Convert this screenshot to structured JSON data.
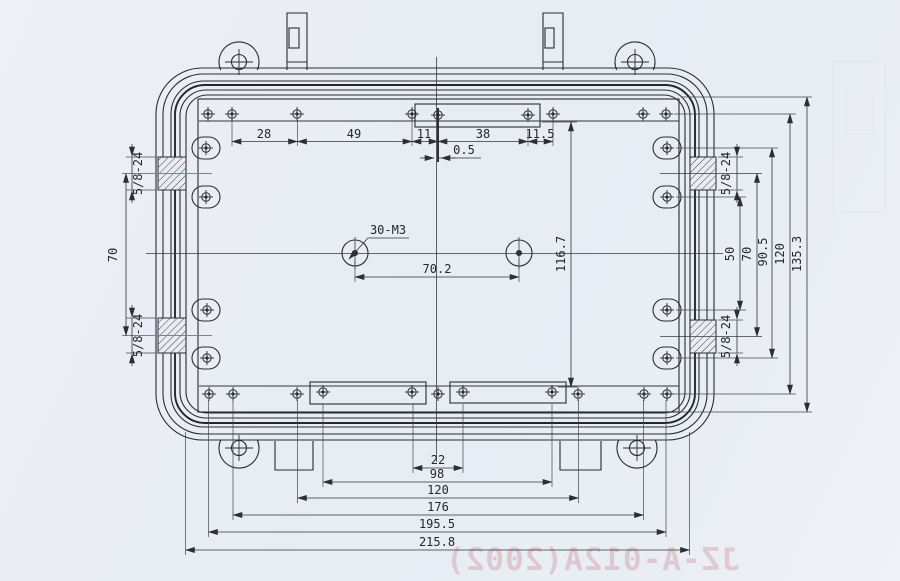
{
  "drawing": {
    "callout_holes": "30-M3",
    "thread_spec": "5/8-24",
    "dim_top": [
      "28",
      "49",
      "11",
      "38",
      "11.5"
    ],
    "dim_offset": "0.5",
    "dim_hole_spacing": "70.2",
    "dim_inner_height": "116.7",
    "dim_left_span": "70",
    "dim_right": [
      "50",
      "70",
      "90.5",
      "120",
      "135.3"
    ],
    "dim_bottom": [
      "22",
      "98",
      "120",
      "176",
      "195.5",
      "215.8"
    ],
    "watermark": "JZ-A-012A(2002)"
  }
}
